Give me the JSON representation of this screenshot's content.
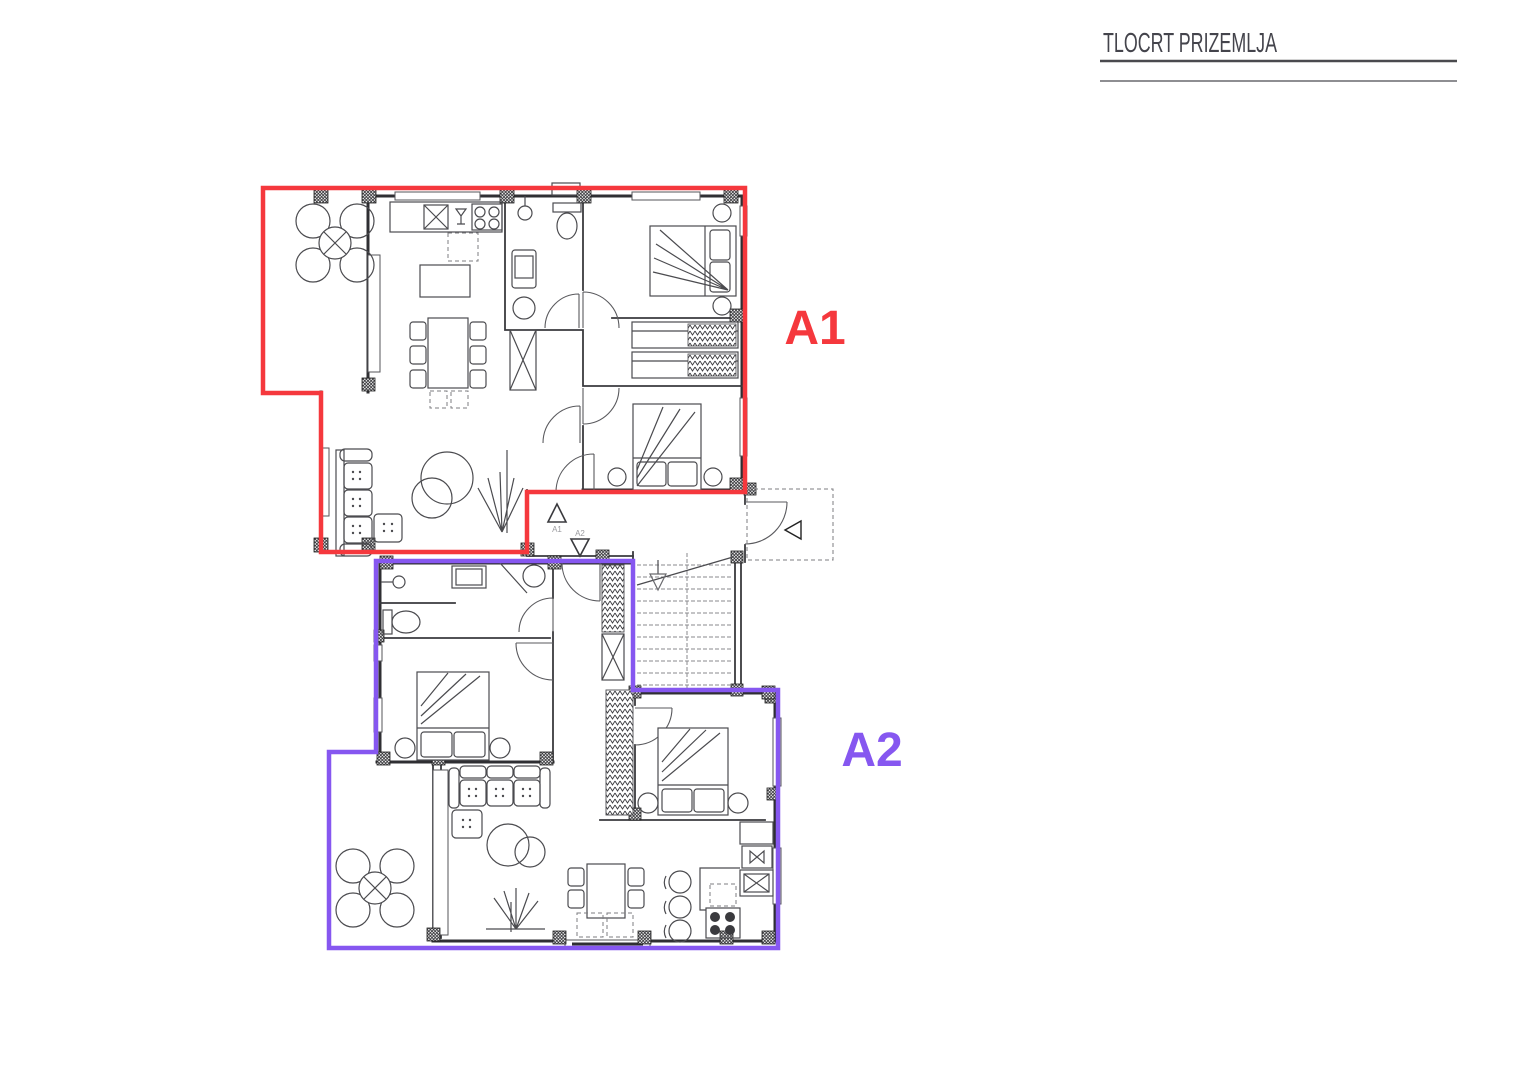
{
  "title": {
    "text": "TLOCRT PRIZEMLJA"
  },
  "apartments": [
    {
      "id": "A1",
      "label": "A1",
      "outline_color": "#f5383d"
    },
    {
      "id": "A2",
      "label": "A2",
      "outline_color": "#8657f0"
    }
  ],
  "entry_markers": [
    {
      "label": "A1",
      "direction": "up"
    },
    {
      "label": "A2",
      "direction": "down"
    }
  ],
  "colors": {
    "a1_outline": "#f5383d",
    "a2_outline": "#8657f0",
    "walls": "#2f2f33",
    "title_text": "#44444c",
    "title_rule_dark": "#4a4a4e",
    "title_rule_light": "#8e8e92"
  },
  "icons": [
    "terrace-table-icon",
    "sofa-icon",
    "dining-table-icon",
    "bed-icon",
    "wardrobe-icon",
    "stove-icon",
    "sink-icon",
    "toilet-icon",
    "shower-icon",
    "washing-machine-icon",
    "stairs-icon",
    "entrance-arrow-icon"
  ]
}
